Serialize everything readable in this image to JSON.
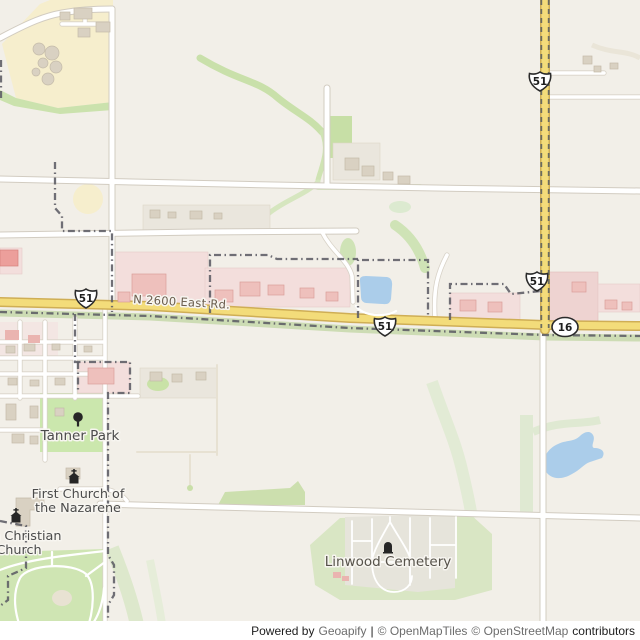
{
  "map": {
    "road_labels": {
      "main_road": "N 2600 East Rd."
    },
    "route_shields": {
      "us51": "51",
      "il16": "16"
    },
    "places": {
      "tanner_park": "Tanner Park",
      "first_church_line1": "First Church of",
      "first_church_line2": "the Nazarene",
      "christian_church_line1": "a Christian",
      "christian_church_line2": "Church",
      "linwood_cemetery": "Linwood Cemetery"
    },
    "icons": [
      "tree-icon",
      "church-icon",
      "church-icon",
      "grave-icon"
    ],
    "colors": {
      "background": "#f2efe8",
      "highway_yellow": "#f3dc7a",
      "highway_casing": "#cfae55",
      "water_blue": "#abcdea",
      "park_green": "#cbe7ad",
      "farmland_yellow": "#f6eecd",
      "retail_pink": "#f3dedc",
      "boundary_gray": "#5c5c64",
      "label_gray": "#4b4b4b"
    }
  },
  "attribution": {
    "powered_by": "Powered by",
    "geoapify": "Geoapify",
    "separator": "|",
    "openmaptiles": "© OpenMapTiles",
    "openstreetmap": "© OpenStreetMap",
    "contributors": "contributors"
  }
}
